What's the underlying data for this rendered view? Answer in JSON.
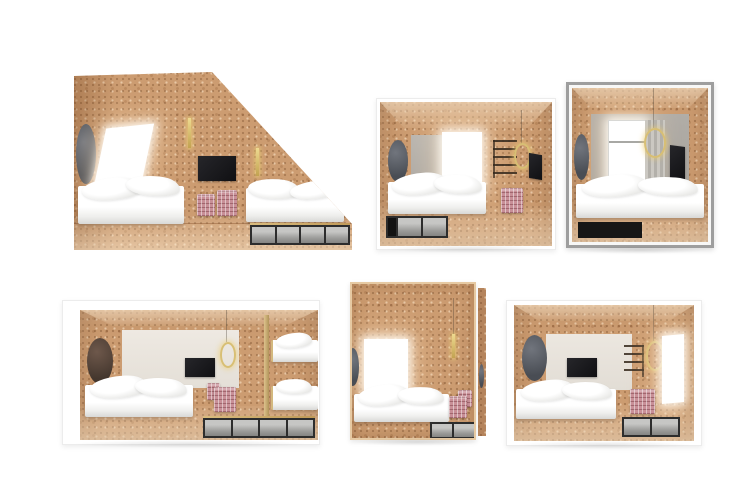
{
  "canvas": {
    "width": 750,
    "height": 504,
    "background": "#ffffff"
  },
  "scene": {
    "kind": "3d-render-collage",
    "subject": "Six cutaway renderings of compact cork-lined hotel bedrooms",
    "grid": {
      "rows": 2,
      "columns": 3
    },
    "text_content": "none"
  },
  "palette": {
    "cork": "#cc9c71",
    "cork_dark": "#b5845c",
    "cork_light": "#ddb286",
    "wall_gray": "#b2aea8",
    "wall_gray_dark": "#aba7a1",
    "wall_panel_light": "#eae5de",
    "metal_frame_gray": "#9e9e9e",
    "bedding_white": "#ffffff",
    "tv_black": "#17171a",
    "brass_gold": "#d8bf74",
    "pouf_pink": "#c88f97",
    "drawer_gray": "#9b9b99",
    "drawer_frame": "#2d2d2d",
    "mirror_slate": "#55585e",
    "mirror_brown": "#5a463c",
    "curtain_gray": "#bdbab4"
  },
  "rooms": [
    {
      "id": "room-1",
      "position": "top-left",
      "view": "attic cutaway with sloped cork ceiling",
      "features": [
        "skylight window",
        "oval wall mirror",
        "two brass tube pendants",
        "wall-mounted tv",
        "two beds with rumpled duvets",
        "plaid pouf pair",
        "four under-bed drawers with brass trim"
      ]
    },
    {
      "id": "room-2",
      "position": "top-center",
      "view": "open box cutaway",
      "features": [
        "oval wall mirror",
        "bed with duvet",
        "back window",
        "gray back-wall section",
        "wall ladder shelf",
        "brass ring light",
        "side-wall tv",
        "plaid pouf",
        "under-bed drawers"
      ]
    },
    {
      "id": "room-3",
      "position": "top-right",
      "view": "metal-framed box cutaway",
      "features": [
        "oval wall mirror",
        "tall back window with curtain",
        "brass ring pendant",
        "side-wall tv",
        "bed with duvet",
        "black under-bed drawer"
      ]
    },
    {
      "id": "room-4",
      "position": "bottom-left",
      "view": "wide box cutaway",
      "features": [
        "oval wall mirror",
        "bed with duvet",
        "light back-wall panel",
        "wall-mounted tv",
        "brass ring pendant",
        "plaid poufs",
        "brass partition",
        "bunk beds",
        "four under-bed drawers with brass trim"
      ]
    },
    {
      "id": "room-5",
      "position": "bottom-center",
      "view": "front elevation of cork room",
      "features": [
        "window",
        "bed with duvet",
        "brass tube pendant",
        "edge-on oval mirrors",
        "plaid poufs",
        "two under-bed drawers"
      ]
    },
    {
      "id": "room-6",
      "position": "bottom-right",
      "view": "open box cutaway",
      "features": [
        "oval wall mirror",
        "bed with duvet",
        "light back-wall panel",
        "wall-mounted tv",
        "wall ladder shelf",
        "brass ring pendant",
        "plaid pouf",
        "side window",
        "two under-bed drawers"
      ]
    }
  ]
}
